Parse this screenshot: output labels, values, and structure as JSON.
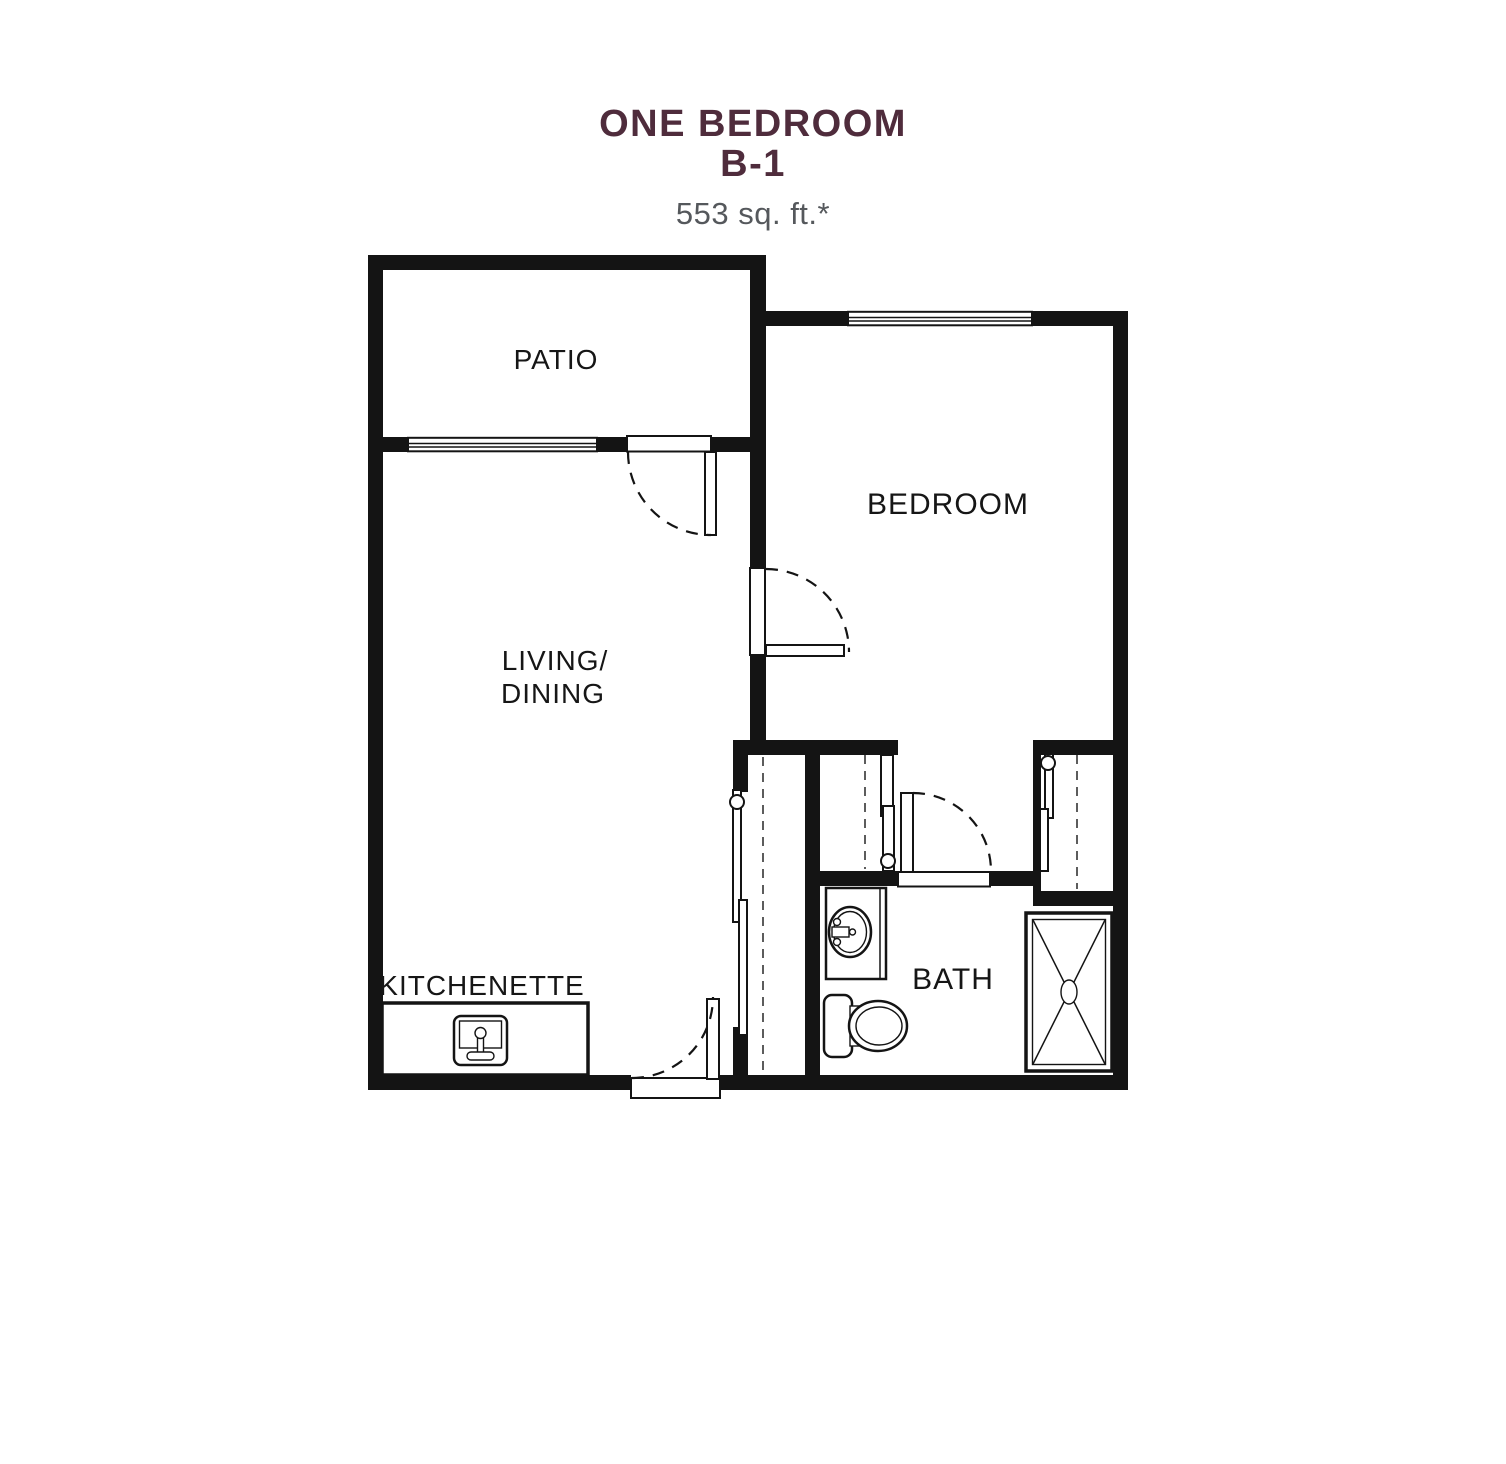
{
  "header": {
    "title_line1": "ONE BEDROOM",
    "title_line2": "B-1",
    "area": "553 sq. ft.*"
  },
  "rooms": {
    "patio": "PATIO",
    "bedroom": "BEDROOM",
    "living_line1": "LIVING/",
    "living_line2": "DINING",
    "kitchenette": "KITCHENETTE",
    "bath": "BATH"
  },
  "fixtures": {
    "kitchenette_sink": "kitchen-sink-icon",
    "bath_sink": "bath-sink-icon",
    "toilet": "toilet-icon",
    "shower": "shower-icon",
    "closet_rods": "closet-rod-dashed-line",
    "doors": "door-swing-arc",
    "windows": "window-symbol"
  },
  "colors": {
    "title": "#4f2c3c",
    "subtitle": "#55585c",
    "walls": "#141414",
    "background": "#ffffff"
  }
}
